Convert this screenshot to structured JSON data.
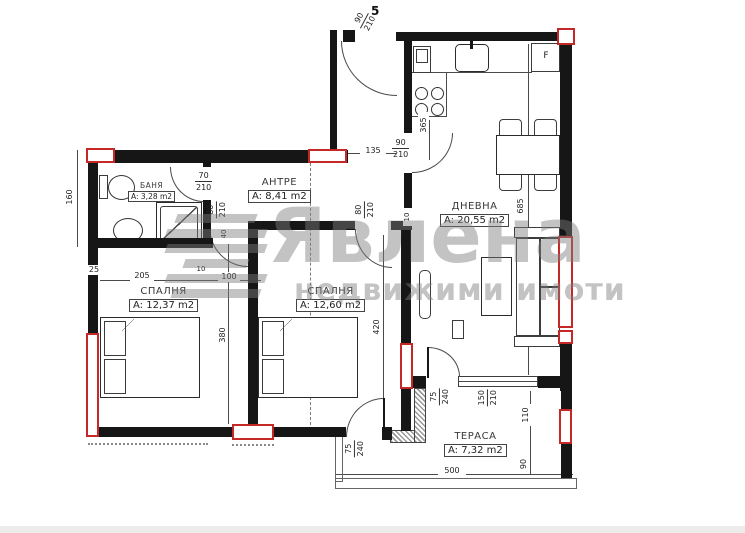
{
  "apartment_number": "5",
  "watermark": {
    "brand": "Явлена",
    "tagline": "недвижими имоти"
  },
  "rooms": {
    "bathroom": {
      "name": "БАНЯ",
      "area": "A: 3,28 m2"
    },
    "entry": {
      "name": "АНТРЕ",
      "area": "A: 8,41 m2"
    },
    "living": {
      "name": "ДНЕВНА",
      "area": "A: 20,55 m2"
    },
    "bedroom1": {
      "name": "СПАЛНЯ",
      "area": "A: 12,37 m2"
    },
    "bedroom2": {
      "name": "СПАЛНЯ",
      "area": "A: 12,60 m2"
    },
    "terrace": {
      "name": "ТЕРАСА",
      "area": "A: 7,32 m2"
    }
  },
  "appliances": {
    "fridge": "F"
  },
  "doors": {
    "entry": {
      "w": "90",
      "h": "210"
    },
    "bath": {
      "w": "70",
      "h": "210"
    },
    "hall_living": {
      "w": "90",
      "h": "210"
    },
    "bedroom1": {
      "w": "80",
      "h": "210"
    },
    "bedroom2": {
      "w": "80",
      "h": "210"
    },
    "terrace_living": {
      "w": "75",
      "h": "240"
    },
    "terrace_bedroom": {
      "w": "75",
      "h": "240"
    },
    "terrace_window": {
      "w": "150",
      "h": "210"
    }
  },
  "dimensions": {
    "left_height": "160",
    "left_offset": "25",
    "bed1_width": "205",
    "wall": "10",
    "hall_width": "100",
    "bed1_length": "380",
    "bed2_length": "420",
    "door_gap": "40",
    "hall_135": "135",
    "kitchen_depth": "365",
    "living_length": "685",
    "living_gap": "10",
    "terrace_110": "110",
    "terrace_90": "90",
    "terrace_width": "500"
  },
  "colors": {
    "wall": "#161616",
    "accent": "#c62828",
    "line": "#444444",
    "watermark": "#7d7d7d"
  }
}
